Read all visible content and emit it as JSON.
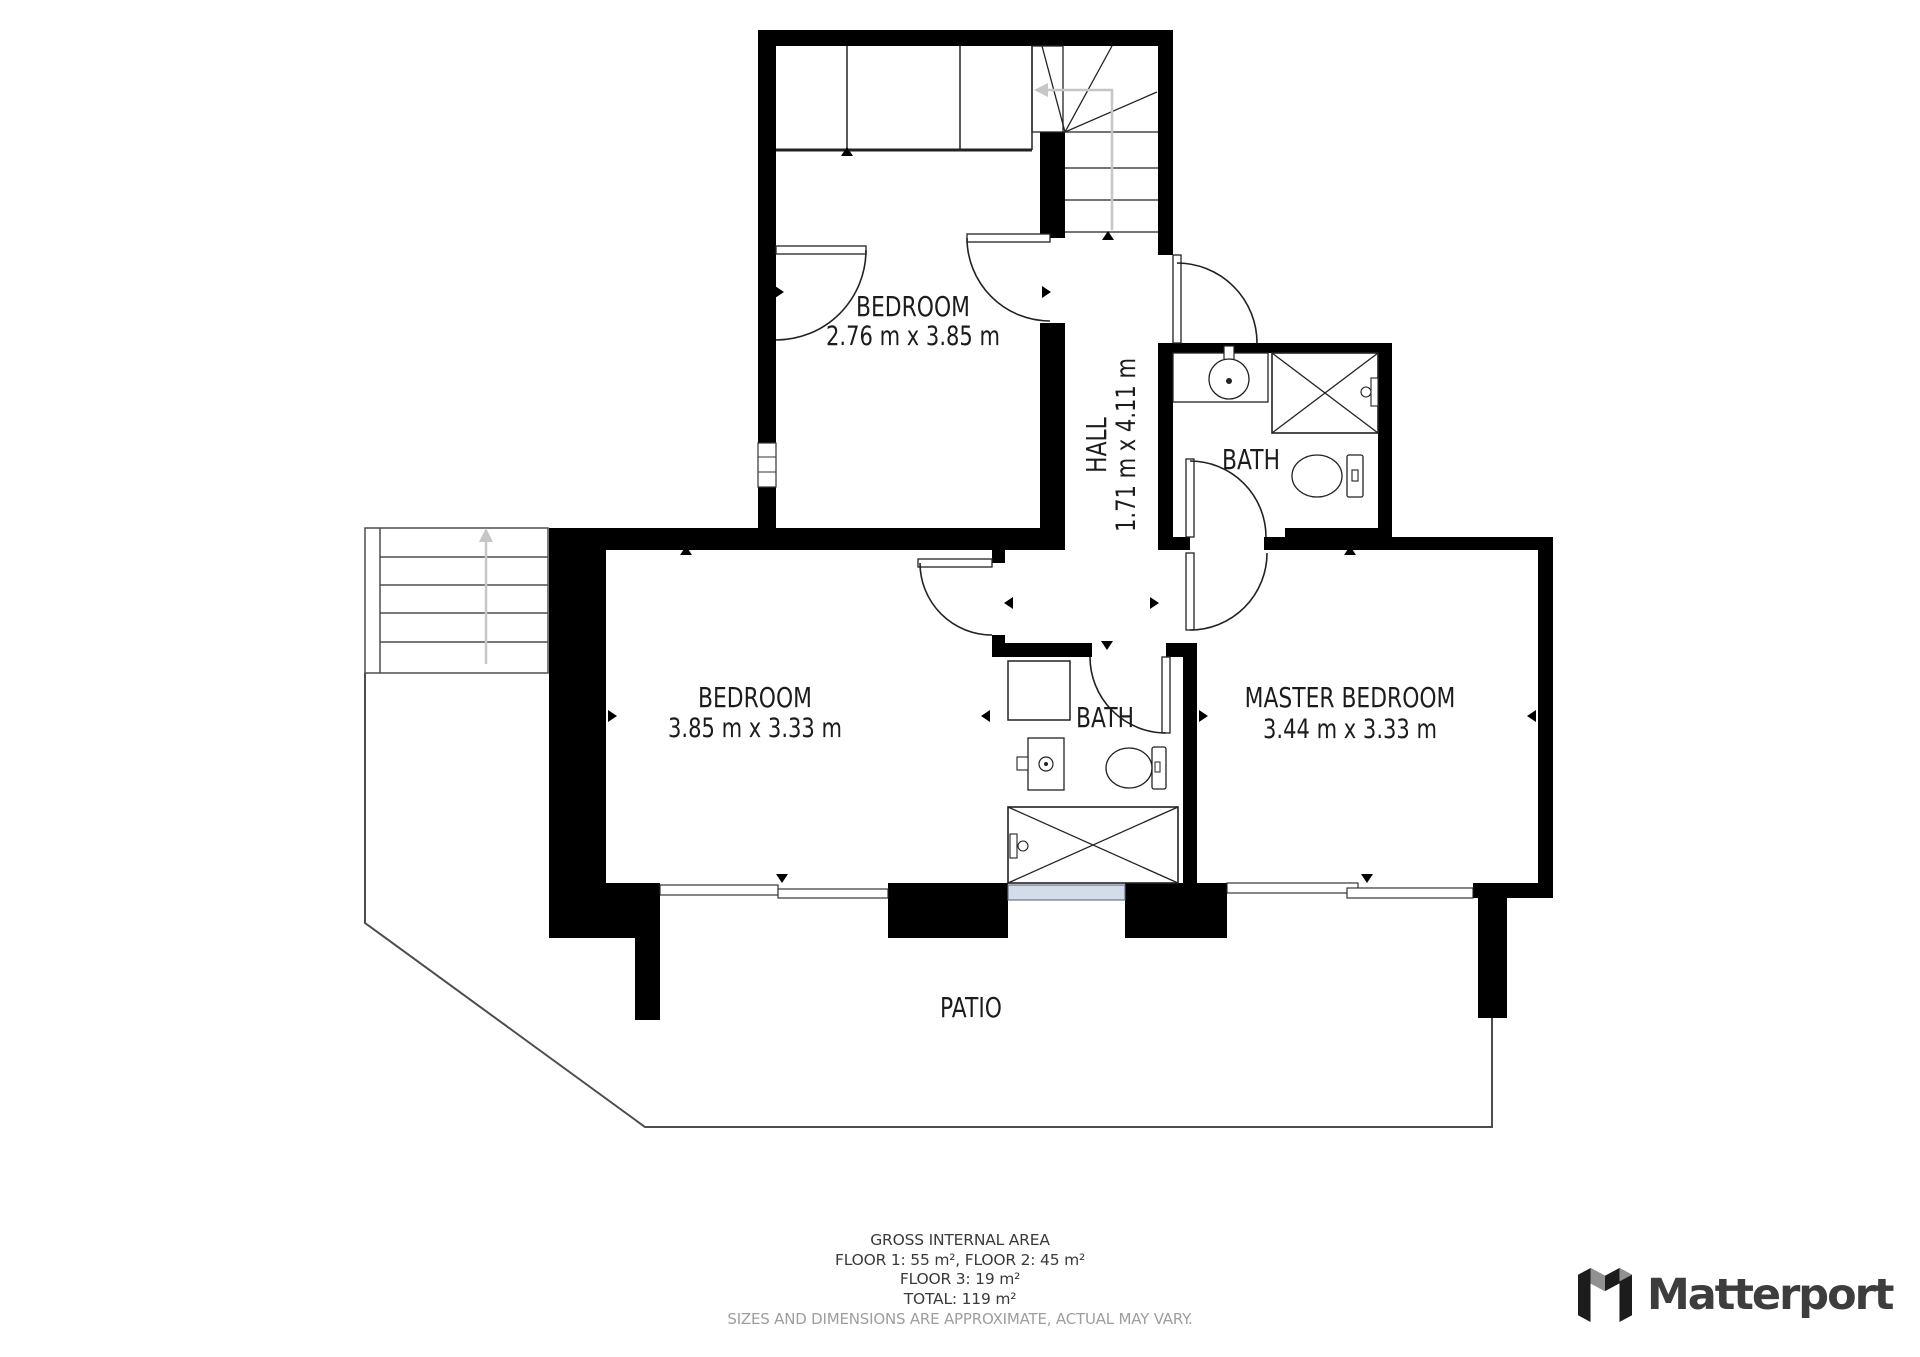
{
  "rooms": {
    "bedroom_top": {
      "name": "BEDROOM",
      "dims": "2.76 m x 3.85 m"
    },
    "bedroom_mid": {
      "name": "BEDROOM",
      "dims": "3.85 m x 3.33 m"
    },
    "master": {
      "name": "MASTER BEDROOM",
      "dims": "3.44 m x 3.33 m"
    },
    "hall": {
      "name": "HALL",
      "dims": "1.71 m x 4.11 m"
    },
    "bath_top": {
      "name": "BATH"
    },
    "bath_mid": {
      "name": "BATH"
    },
    "patio": {
      "name": "PATIO"
    }
  },
  "footer": {
    "title": "GROSS INTERNAL AREA",
    "floors_1_2": "FLOOR 1: 55 m², FLOOR 2: 45 m²",
    "floor_3": "FLOOR 3: 19 m²",
    "total": "TOTAL: 119 m²",
    "disclaimer": "SIZES AND DIMENSIONS ARE APPROXIMATE, ACTUAL MAY VARY."
  },
  "logo": {
    "text": "Matterport"
  },
  "colors": {
    "wall": "#000000",
    "line": "#222222",
    "gray_arrow": "#c6c6c6",
    "window_fill": "#d4dcea",
    "footer_gray": "#9e9e9e",
    "logo_text": "#3d3d3d"
  }
}
